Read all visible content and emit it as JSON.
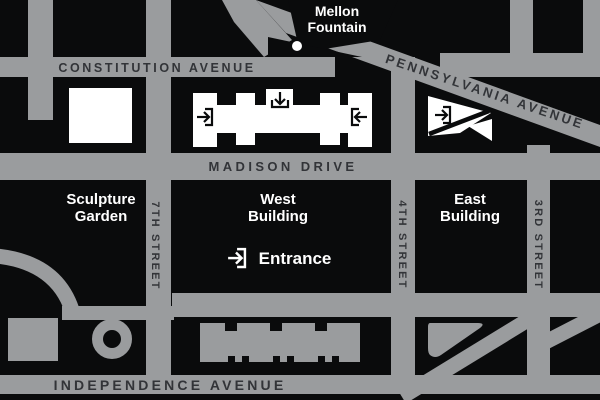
{
  "map": {
    "title": "National Gallery of Art area map",
    "colors": {
      "background_black": "#0a0b0c",
      "street_gray": "#9a9c9e",
      "street_text_dark": "#323438",
      "building_white": "#ffffff"
    },
    "streets": {
      "constitution": "CONSTITUTION AVENUE",
      "pennsylvania": "PENNSYLVANIA AVENUE",
      "madison": "MADISON DRIVE",
      "independence": "INDEPENDENCE AVENUE",
      "seventh": "7TH STREET",
      "fourth": "4TH STREET",
      "third": "3RD STREET"
    },
    "labels": {
      "mellon_line1": "Mellon",
      "mellon_line2": "Fountain",
      "sculpture_line1": "Sculpture",
      "sculpture_line2": "Garden",
      "west_line1": "West",
      "west_line2": "Building",
      "east_line1": "East",
      "east_line2": "Building",
      "entrance": "Entrance"
    },
    "icons": {
      "entrance_icon": "arrow-into-bracket"
    }
  }
}
